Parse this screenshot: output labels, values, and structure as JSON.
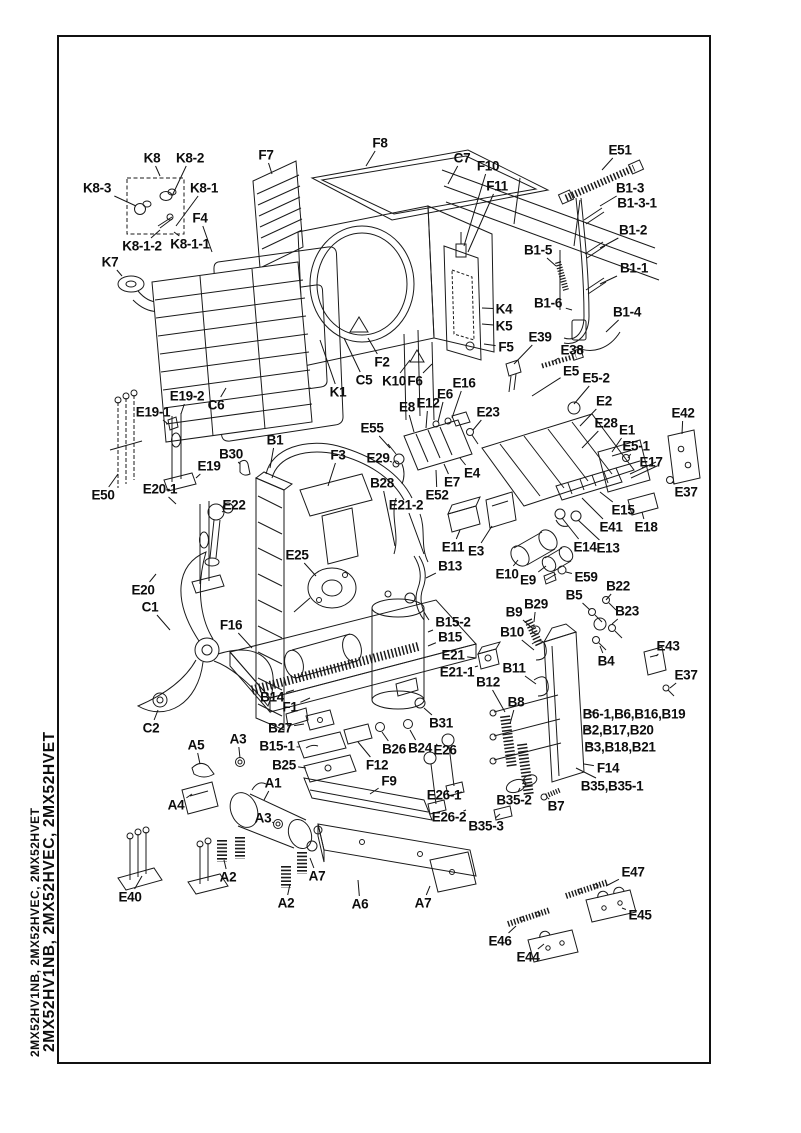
{
  "colors": {
    "ink": "#141414",
    "paper": "#ffffff"
  },
  "sidebar": {
    "model_codes_outer": "2MX52HV1NB, 2MX52HVEC, 2MX52HVET",
    "model_codes_inner": "2MX52HV1NB, 2MX52HVEC, 2MX52HVET"
  },
  "diagram": {
    "labels": [
      {
        "t": "K8",
        "x": 152,
        "y": 158,
        "lx": 160,
        "ly": 176
      },
      {
        "t": "K8-2",
        "x": 190,
        "y": 158,
        "lx": 172,
        "ly": 196
      },
      {
        "t": "K8-3",
        "x": 97,
        "y": 188,
        "lx": 136,
        "ly": 206
      },
      {
        "t": "K8-1",
        "x": 204,
        "y": 188,
        "lx": 176,
        "ly": 226
      },
      {
        "t": "F4",
        "x": 200,
        "y": 218,
        "lx": 212,
        "ly": 252
      },
      {
        "t": "K8-1-2",
        "x": 142,
        "y": 246,
        "lx": 160,
        "ly": 230
      },
      {
        "t": "K8-1-1",
        "x": 190,
        "y": 244,
        "lx": 174,
        "ly": 232
      },
      {
        "t": "K7",
        "x": 110,
        "y": 262,
        "lx": 122,
        "ly": 276
      },
      {
        "t": "F7",
        "x": 266,
        "y": 155,
        "lx": 272,
        "ly": 174
      },
      {
        "t": "F8",
        "x": 380,
        "y": 143,
        "lx": 366,
        "ly": 166
      },
      {
        "t": "C7",
        "x": 462,
        "y": 158,
        "lx": 448,
        "ly": 184
      },
      {
        "t": "F10",
        "x": 488,
        "y": 166,
        "lx": 464,
        "ly": 246
      },
      {
        "t": "F11",
        "x": 497,
        "y": 186,
        "lx": 468,
        "ly": 252
      },
      {
        "t": "E51",
        "x": 620,
        "y": 150,
        "lx": 602,
        "ly": 170
      },
      {
        "t": "B1-3",
        "x": 630,
        "y": 188,
        "lx": 600,
        "ly": 206
      },
      {
        "t": "B1-3-1",
        "x": 637,
        "y": 203
      },
      {
        "t": "B1-2",
        "x": 633,
        "y": 230,
        "lx": 600,
        "ly": 248
      },
      {
        "t": "B1-5",
        "x": 538,
        "y": 250,
        "lx": 556,
        "ly": 266
      },
      {
        "t": "B1-1",
        "x": 634,
        "y": 268,
        "lx": 600,
        "ly": 284
      },
      {
        "t": "B1-6",
        "x": 548,
        "y": 303,
        "lx": 572,
        "ly": 310
      },
      {
        "t": "B1-4",
        "x": 627,
        "y": 312,
        "lx": 606,
        "ly": 332
      },
      {
        "t": "K4",
        "x": 504,
        "y": 309,
        "lx": 482,
        "ly": 308
      },
      {
        "t": "K5",
        "x": 504,
        "y": 326,
        "lx": 482,
        "ly": 324
      },
      {
        "t": "F5",
        "x": 506,
        "y": 347,
        "lx": 484,
        "ly": 344
      },
      {
        "t": "E39",
        "x": 540,
        "y": 337,
        "lx": 514,
        "ly": 364
      },
      {
        "t": "E38",
        "x": 572,
        "y": 350,
        "lx": 552,
        "ly": 362
      },
      {
        "t": "E5",
        "x": 571,
        "y": 371,
        "lx": 532,
        "ly": 396
      },
      {
        "t": "E5-2",
        "x": 596,
        "y": 378,
        "lx": 574,
        "ly": 404
      },
      {
        "t": "E2",
        "x": 604,
        "y": 401,
        "lx": 580,
        "ly": 426
      },
      {
        "t": "E28",
        "x": 606,
        "y": 423,
        "lx": 582,
        "ly": 448
      },
      {
        "t": "E1",
        "x": 627,
        "y": 430,
        "lx": 612,
        "ly": 452
      },
      {
        "t": "E42",
        "x": 683,
        "y": 413,
        "lx": 682,
        "ly": 434
      },
      {
        "t": "E5-1",
        "x": 636,
        "y": 446,
        "lx": 628,
        "ly": 458
      },
      {
        "t": "E17",
        "x": 651,
        "y": 462,
        "lx": 642,
        "ly": 468
      },
      {
        "t": "E37",
        "x": 686,
        "y": 492,
        "lx": 672,
        "ly": 482
      },
      {
        "t": "E15",
        "x": 623,
        "y": 510,
        "lx": 600,
        "ly": 492
      },
      {
        "t": "E41",
        "x": 611,
        "y": 527,
        "lx": 582,
        "ly": 498
      },
      {
        "t": "E18",
        "x": 646,
        "y": 527,
        "lx": 642,
        "ly": 512
      },
      {
        "t": "E14",
        "x": 585,
        "y": 547,
        "lx": 562,
        "ly": 518
      },
      {
        "t": "E13",
        "x": 608,
        "y": 548,
        "lx": 578,
        "ly": 520
      },
      {
        "t": "E10",
        "x": 507,
        "y": 574,
        "lx": 518,
        "ly": 560
      },
      {
        "t": "E9",
        "x": 528,
        "y": 580,
        "lx": 546,
        "ly": 566
      },
      {
        "t": "E59",
        "x": 586,
        "y": 577,
        "lx": 566,
        "ly": 572
      },
      {
        "t": "B22",
        "x": 618,
        "y": 586,
        "lx": 606,
        "ly": 600
      },
      {
        "t": "B5",
        "x": 574,
        "y": 595,
        "lx": 590,
        "ly": 610
      },
      {
        "t": "B29",
        "x": 536,
        "y": 604,
        "lx": 534,
        "ly": 622
      },
      {
        "t": "B9",
        "x": 514,
        "y": 612,
        "lx": 532,
        "ly": 628
      },
      {
        "t": "B23",
        "x": 627,
        "y": 611,
        "lx": 612,
        "ly": 624
      },
      {
        "t": "B10",
        "x": 512,
        "y": 632,
        "lx": 534,
        "ly": 650
      },
      {
        "t": "E43",
        "x": 668,
        "y": 646,
        "lx": 656,
        "ly": 656
      },
      {
        "t": "B11",
        "x": 514,
        "y": 668,
        "lx": 536,
        "ly": 684
      },
      {
        "t": "E37",
        "x": 686,
        "y": 675,
        "lx": 670,
        "ly": 688
      },
      {
        "t": "B4",
        "x": 606,
        "y": 661,
        "lx": 600,
        "ly": 646
      },
      {
        "t": "B12",
        "x": 488,
        "y": 682,
        "lx": 505,
        "ly": 712
      },
      {
        "t": "B8",
        "x": 516,
        "y": 702,
        "lx": 510,
        "ly": 724
      },
      {
        "t": "B6-1,B6,B16,B19",
        "x": 634,
        "y": 714,
        "lx": 588,
        "ly": 712
      },
      {
        "t": "B2,B17,B20",
        "x": 618,
        "y": 730,
        "lx": 586,
        "ly": 728
      },
      {
        "t": "B3,B18,B21",
        "x": 620,
        "y": 747,
        "lx": 588,
        "ly": 744
      },
      {
        "t": "F14",
        "x": 608,
        "y": 768,
        "lx": 584,
        "ly": 764
      },
      {
        "t": "B35,B35-1",
        "x": 612,
        "y": 786,
        "lx": 576,
        "ly": 768
      },
      {
        "t": "F2",
        "x": 382,
        "y": 362,
        "lx": 368,
        "ly": 338
      },
      {
        "t": "C5",
        "x": 364,
        "y": 380,
        "lx": 344,
        "ly": 338
      },
      {
        "t": "K1",
        "x": 338,
        "y": 392,
        "lx": 320,
        "ly": 340
      },
      {
        "t": "K10",
        "x": 394,
        "y": 381,
        "lx": 410,
        "ly": 360
      },
      {
        "t": "F6",
        "x": 415,
        "y": 381,
        "lx": 432,
        "ly": 364
      },
      {
        "t": "E16",
        "x": 464,
        "y": 383,
        "lx": 452,
        "ly": 418
      },
      {
        "t": "E6",
        "x": 445,
        "y": 394,
        "lx": 438,
        "ly": 422
      },
      {
        "t": "E12",
        "x": 428,
        "y": 403,
        "lx": 426,
        "ly": 428
      },
      {
        "t": "E8",
        "x": 407,
        "y": 407,
        "lx": 414,
        "ly": 432
      },
      {
        "t": "E23",
        "x": 488,
        "y": 412,
        "lx": 473,
        "ly": 430
      },
      {
        "t": "E55",
        "x": 372,
        "y": 428,
        "lx": 390,
        "ly": 448
      },
      {
        "t": "E29",
        "x": 378,
        "y": 458,
        "lx": 392,
        "ly": 462
      },
      {
        "t": "B1",
        "x": 275,
        "y": 440,
        "lx": 270,
        "ly": 468
      },
      {
        "t": "F3",
        "x": 338,
        "y": 455,
        "lx": 328,
        "ly": 486
      },
      {
        "t": "B28",
        "x": 382,
        "y": 483,
        "lx": 395,
        "ly": 546
      },
      {
        "t": "E21-2",
        "x": 406,
        "y": 505,
        "lx": 424,
        "ly": 554
      },
      {
        "t": "E52",
        "x": 437,
        "y": 495,
        "lx": 436,
        "ly": 470
      },
      {
        "t": "E7",
        "x": 452,
        "y": 482,
        "lx": 444,
        "ly": 464
      },
      {
        "t": "E4",
        "x": 472,
        "y": 473,
        "lx": 460,
        "ly": 458
      },
      {
        "t": "E11",
        "x": 453,
        "y": 547,
        "lx": 460,
        "ly": 530
      },
      {
        "t": "E3",
        "x": 476,
        "y": 551,
        "lx": 492,
        "ly": 526
      },
      {
        "t": "B13",
        "x": 450,
        "y": 566,
        "lx": 426,
        "ly": 578
      },
      {
        "t": "E25",
        "x": 297,
        "y": 555,
        "lx": 316,
        "ly": 576
      },
      {
        "t": "B15-2",
        "x": 453,
        "y": 622,
        "lx": 428,
        "ly": 632
      },
      {
        "t": "B15",
        "x": 450,
        "y": 637,
        "lx": 428,
        "ly": 646
      },
      {
        "t": "E21",
        "x": 453,
        "y": 655,
        "lx": 476,
        "ly": 658
      },
      {
        "t": "E21-1",
        "x": 457,
        "y": 672,
        "lx": 478,
        "ly": 666
      },
      {
        "t": "E19-2",
        "x": 187,
        "y": 396,
        "lx": 181,
        "ly": 414
      },
      {
        "t": "E19-1",
        "x": 153,
        "y": 412,
        "lx": 168,
        "ly": 424
      },
      {
        "t": "C6",
        "x": 216,
        "y": 405,
        "lx": 226,
        "ly": 388
      },
      {
        "t": "B30",
        "x": 231,
        "y": 454,
        "lx": 240,
        "ly": 464
      },
      {
        "t": "E19",
        "x": 209,
        "y": 466,
        "lx": 196,
        "ly": 478
      },
      {
        "t": "E20-1",
        "x": 160,
        "y": 489,
        "lx": 176,
        "ly": 504
      },
      {
        "t": "E50",
        "x": 103,
        "y": 495,
        "lx": 118,
        "ly": 474
      },
      {
        "t": "E22",
        "x": 234,
        "y": 505,
        "lx": 222,
        "ly": 512
      },
      {
        "t": "E20",
        "x": 143,
        "y": 590,
        "lx": 156,
        "ly": 574
      },
      {
        "t": "C1",
        "x": 150,
        "y": 607,
        "lx": 170,
        "ly": 630
      },
      {
        "t": "F16",
        "x": 231,
        "y": 625,
        "lx": 252,
        "ly": 648
      },
      {
        "t": "C2",
        "x": 151,
        "y": 728,
        "lx": 158,
        "ly": 710
      },
      {
        "t": "B14",
        "x": 272,
        "y": 697,
        "lx": 294,
        "ly": 690
      },
      {
        "t": "F1",
        "x": 290,
        "y": 707,
        "lx": 310,
        "ly": 698
      },
      {
        "t": "B27",
        "x": 280,
        "y": 728,
        "lx": 304,
        "ly": 724
      },
      {
        "t": "B15-1",
        "x": 277,
        "y": 746,
        "lx": 300,
        "ly": 747
      },
      {
        "t": "B25",
        "x": 284,
        "y": 765,
        "lx": 306,
        "ly": 768
      },
      {
        "t": "A5",
        "x": 196,
        "y": 745,
        "lx": 200,
        "ly": 764
      },
      {
        "t": "A3",
        "x": 238,
        "y": 739,
        "lx": 240,
        "ly": 758
      },
      {
        "t": "A4",
        "x": 176,
        "y": 805,
        "lx": 192,
        "ly": 794
      },
      {
        "t": "A1",
        "x": 273,
        "y": 783,
        "lx": 264,
        "ly": 800
      },
      {
        "t": "A3",
        "x": 263,
        "y": 818,
        "lx": 274,
        "ly": 823
      },
      {
        "t": "A2",
        "x": 228,
        "y": 877,
        "lx": 224,
        "ly": 860
      },
      {
        "t": "A7",
        "x": 317,
        "y": 876,
        "lx": 310,
        "ly": 858
      },
      {
        "t": "A2",
        "x": 286,
        "y": 903,
        "lx": 290,
        "ly": 884
      },
      {
        "t": "A6",
        "x": 360,
        "y": 904,
        "lx": 358,
        "ly": 880
      },
      {
        "t": "A7",
        "x": 423,
        "y": 903,
        "lx": 430,
        "ly": 886
      },
      {
        "t": "E40",
        "x": 130,
        "y": 897,
        "lx": 142,
        "ly": 876
      },
      {
        "t": "B31",
        "x": 441,
        "y": 723,
        "lx": 424,
        "ly": 708
      },
      {
        "t": "B26",
        "x": 394,
        "y": 749,
        "lx": 382,
        "ly": 732
      },
      {
        "t": "B24",
        "x": 420,
        "y": 748,
        "lx": 410,
        "ly": 730
      },
      {
        "t": "F12",
        "x": 377,
        "y": 765,
        "lx": 358,
        "ly": 742
      },
      {
        "t": "F9",
        "x": 389,
        "y": 781,
        "lx": 370,
        "ly": 794
      },
      {
        "t": "E26",
        "x": 445,
        "y": 750,
        "lx": 436,
        "ly": 744
      },
      {
        "t": "E26-1",
        "x": 444,
        "y": 795,
        "lx": 462,
        "ly": 792
      },
      {
        "t": "E26-2",
        "x": 449,
        "y": 817,
        "lx": 466,
        "ly": 810
      },
      {
        "t": "B35-3",
        "x": 486,
        "y": 826,
        "lx": 500,
        "ly": 814
      },
      {
        "t": "B35-2",
        "x": 514,
        "y": 800,
        "lx": 520,
        "ly": 788
      },
      {
        "t": "B7",
        "x": 556,
        "y": 806,
        "lx": 548,
        "ly": 798
      },
      {
        "t": "E47",
        "x": 633,
        "y": 872,
        "lx": 606,
        "ly": 886
      },
      {
        "t": "E45",
        "x": 640,
        "y": 915,
        "lx": 622,
        "ly": 908
      },
      {
        "t": "E46",
        "x": 500,
        "y": 941,
        "lx": 516,
        "ly": 926
      },
      {
        "t": "E44",
        "x": 528,
        "y": 957,
        "lx": 544,
        "ly": 944
      }
    ]
  }
}
